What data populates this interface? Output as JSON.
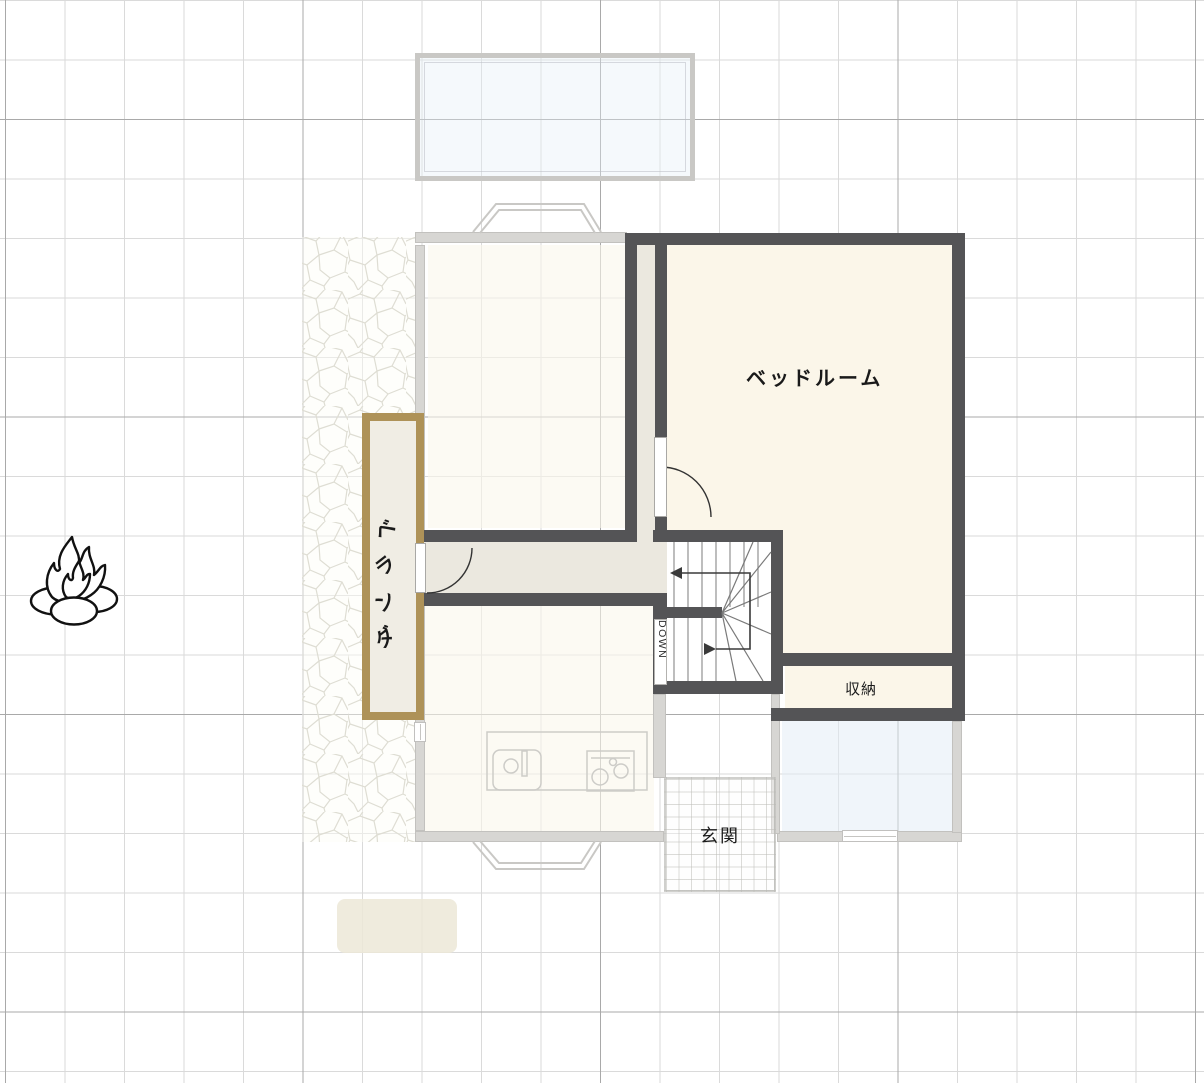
{
  "floor_plan": {
    "rooms": {
      "bedroom": {
        "label": "ベッドルーム"
      },
      "storage": {
        "label": "収納"
      },
      "veranda": {
        "label_chars": [
          "ベ",
          "ラ",
          "ン",
          "ダ"
        ]
      },
      "stairs": {
        "direction_label": "DOWN"
      },
      "entrance_ghost": {
        "label": "玄関"
      }
    },
    "icons": {
      "bonfire": "bonfire-icon"
    },
    "colors": {
      "wall": "#545456",
      "room_fill": "#fbf6e9",
      "hall_fill": "#ebe8df",
      "veranda_border": "#ae9258",
      "veranda_fill": "#f0ede4",
      "ghost_gray": "#c9c8c5",
      "ghost_blue_fill": "#e4eef8",
      "grid_minor": "#dadada",
      "grid_major": "#a9a9a9",
      "label_text": "#1a1a1a",
      "ghost_text": "#c0beba"
    }
  }
}
